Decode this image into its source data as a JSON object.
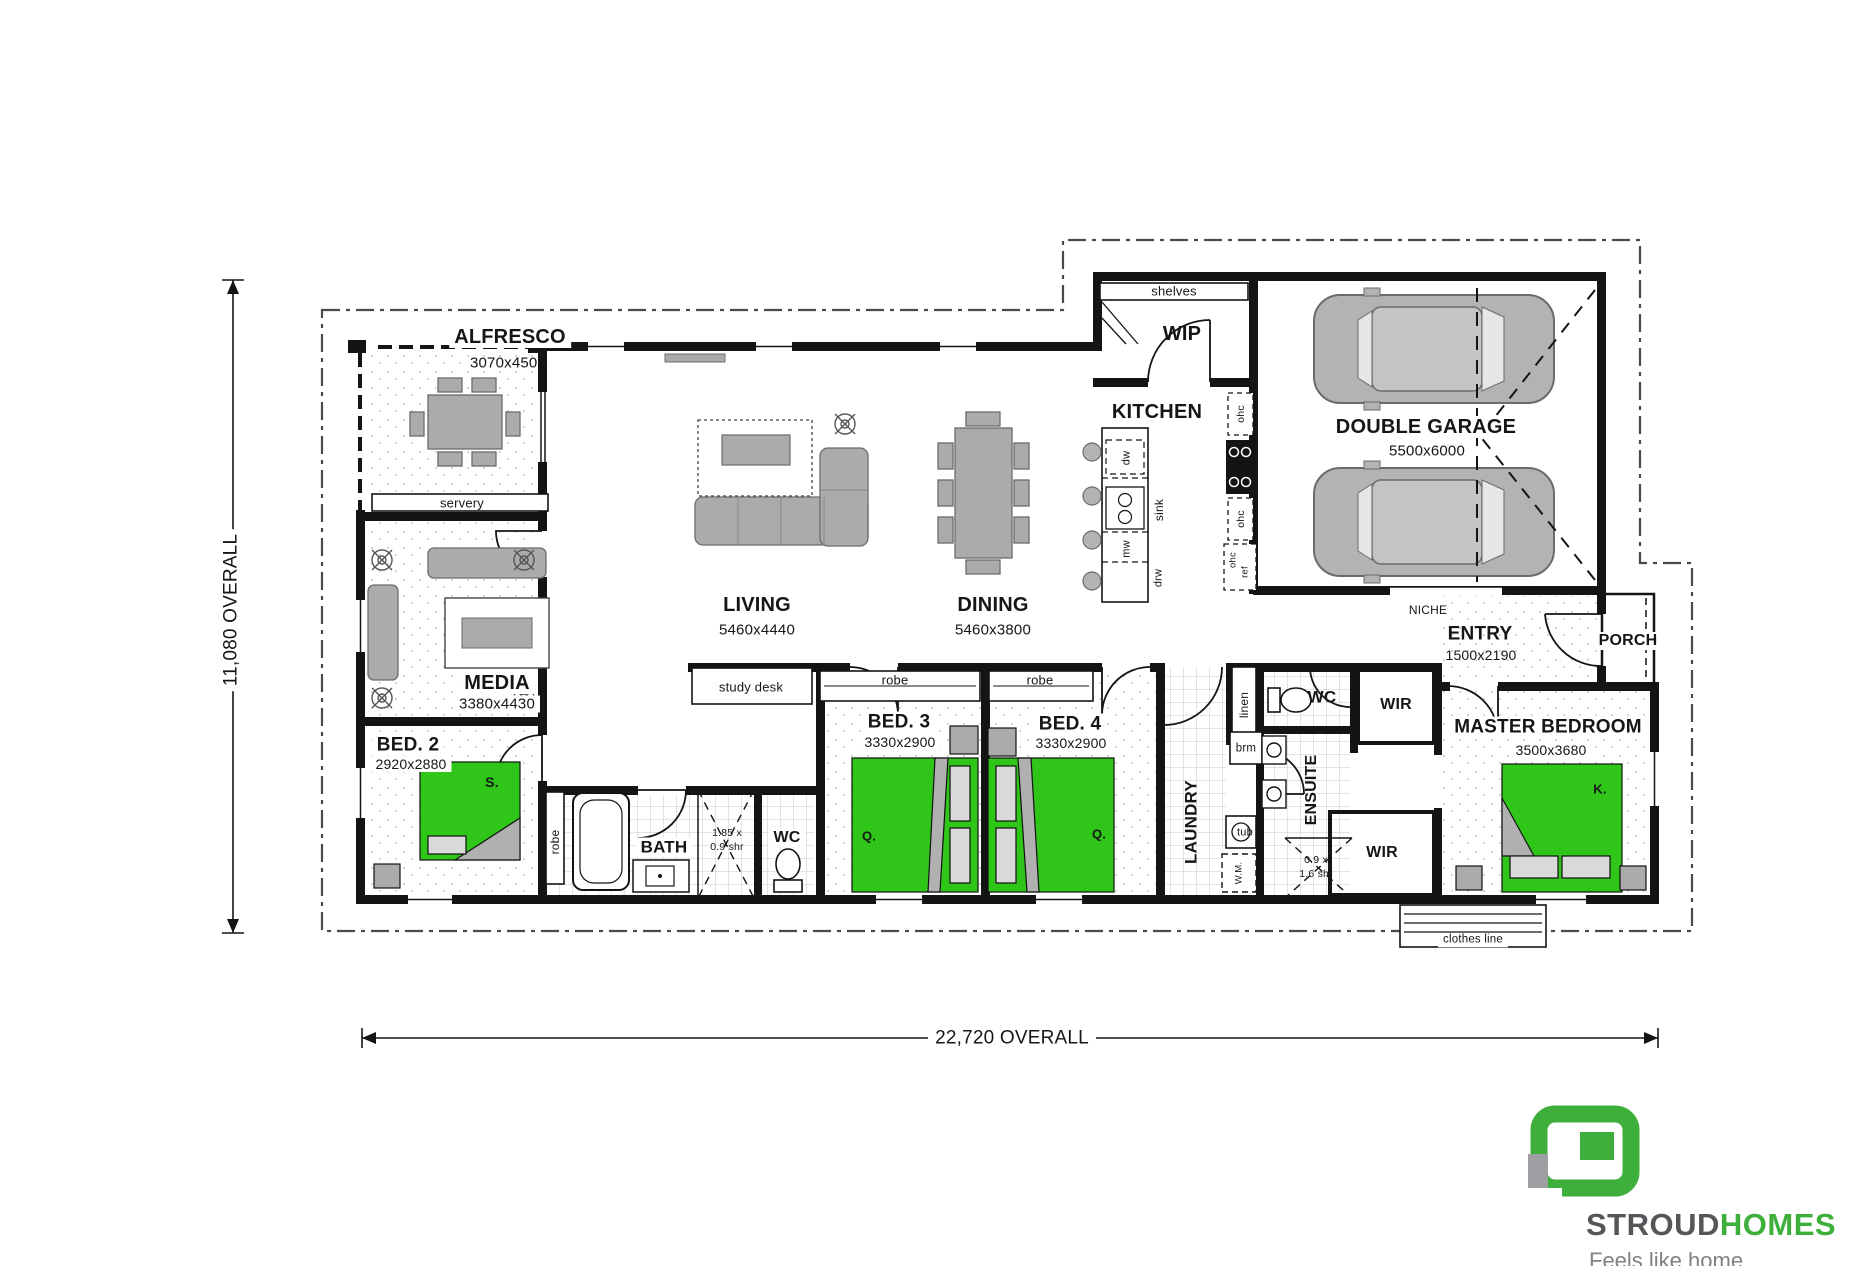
{
  "dimensions": {
    "height_label": "11,080 OVERALL",
    "width_label": "22,720 OVERALL"
  },
  "rooms": {
    "alfresco": {
      "name": "ALFRESCO",
      "size": "3070x4500"
    },
    "wip": {
      "name": "WIP"
    },
    "kitchen": {
      "name": "KITCHEN"
    },
    "garage": {
      "name": "DOUBLE GARAGE",
      "size": "5500x6000"
    },
    "living": {
      "name": "LIVING",
      "size": "5460x4440"
    },
    "dining": {
      "name": "DINING",
      "size": "5460x3800"
    },
    "media": {
      "name": "MEDIA",
      "size": "3380x4430"
    },
    "bed2": {
      "name": "BED. 2",
      "size": "2920x2880",
      "bed_tag": "S."
    },
    "bed3": {
      "name": "BED. 3",
      "size": "3330x2900",
      "bed_tag": "Q."
    },
    "bed4": {
      "name": "BED. 4",
      "size": "3330x2900",
      "bed_tag": "Q."
    },
    "master": {
      "name": "MASTER BEDROOM",
      "size": "3500x3680",
      "bed_tag": "K."
    },
    "entry": {
      "name": "ENTRY",
      "size": "1500x2190"
    },
    "porch": {
      "name": "PORCH"
    },
    "bath": {
      "name": "BATH"
    },
    "wc": {
      "name": "WC"
    },
    "wc2": {
      "name": "WC"
    },
    "laundry": {
      "name": "LAUNDRY"
    },
    "ensuite": {
      "name": "ENSUITE"
    },
    "wir": {
      "name": "WIR"
    },
    "wir2": {
      "name": "WIR"
    },
    "niche": {
      "name": "NICHE"
    }
  },
  "fixtures": {
    "shelves": "shelves",
    "servery": "servery",
    "study_desk": "study desk",
    "robe": "robe",
    "linen": "linen",
    "brm": "brm",
    "tub": "tub",
    "wm": "W.M.",
    "dw": "dw",
    "sink": "sink",
    "mw": "mw",
    "drw": "drw",
    "ohc": "ohc",
    "ref": "ref",
    "shower_bath_l1": "1.85 x",
    "shower_bath_l2": "0.9 shr",
    "shower_ens_l1": "0.9 x",
    "shower_ens_l2": "1.6 shr",
    "clothes_line": "clothes line"
  },
  "logo": {
    "brand_primary": "STROUD",
    "brand_secondary": "HOMES",
    "tagline": "Feels like home"
  },
  "colors": {
    "bed_green": "#2fc619",
    "logo_green": "#3faf3c",
    "brand_gray": "#54565a",
    "wall_black": "#141414",
    "furniture_gray": "#ababab"
  }
}
